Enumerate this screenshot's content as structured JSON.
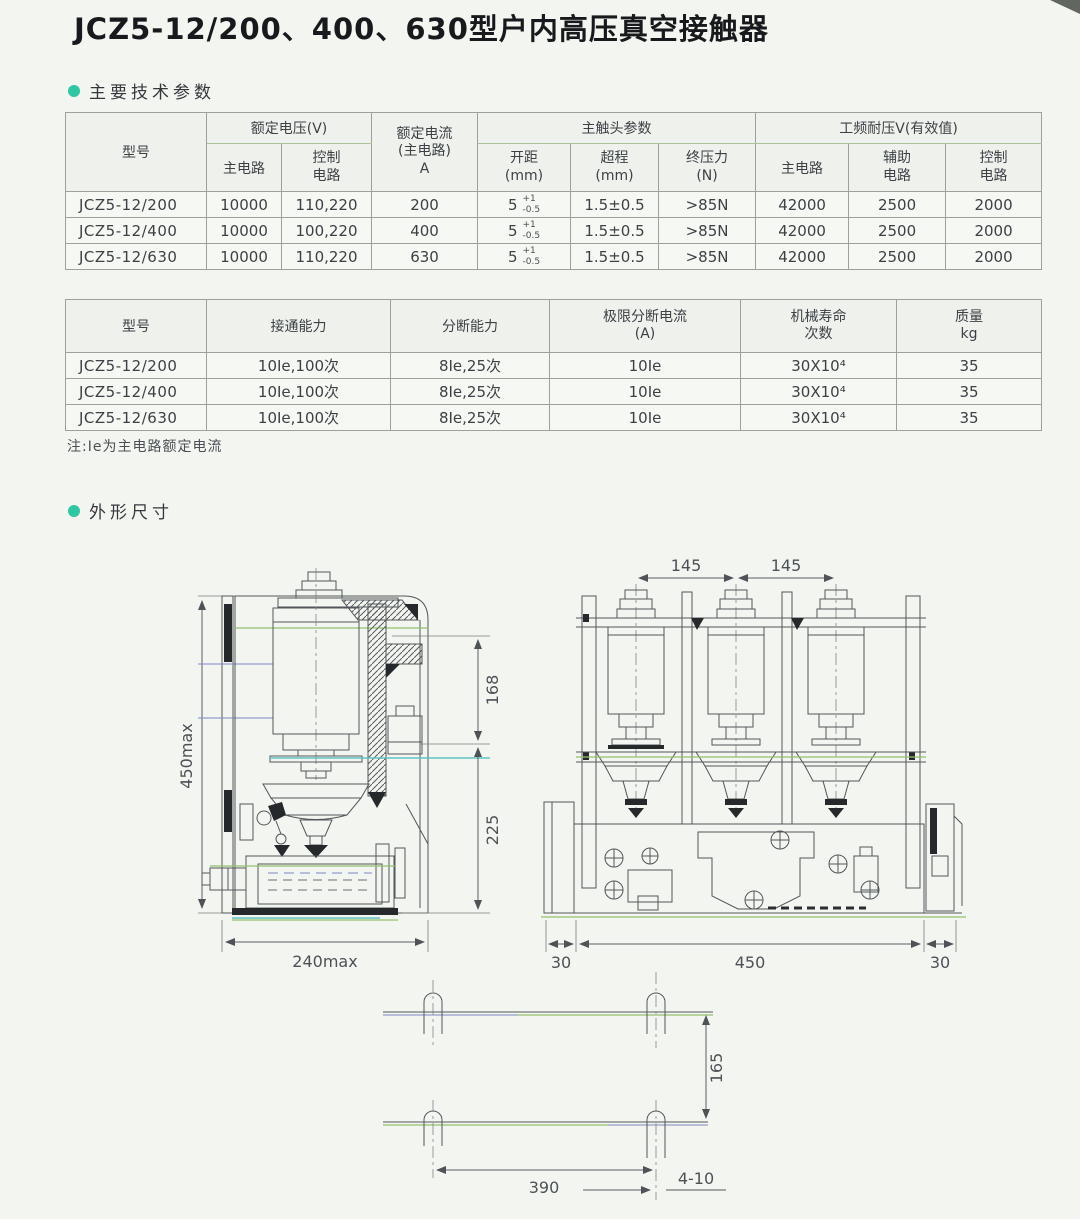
{
  "page": {
    "title": "JCZ5-12/200、400、630型户内高压真空接触器",
    "accent_color": "#2ec7a2"
  },
  "sections": {
    "params_label": "主要技术参数",
    "dims_label": "外形尺寸"
  },
  "table1": {
    "headers": {
      "model": "型号",
      "rated_voltage_group": "额定电压(V)",
      "main_circuit": "主电路",
      "control_circuit": "控制\n电路",
      "rated_current": "额定电流\n(主电路)\nA",
      "contact_group": "主触头参数",
      "opening": "开距\n(mm)",
      "overtravel": "超程\n(mm)",
      "final_pressure": "终压力\n(N)",
      "withstand_group": "工频耐压V(有效值)",
      "withstand_main": "主电路",
      "withstand_aux": "辅助\n电路",
      "withstand_control": "控制\n电路"
    },
    "rows": [
      {
        "model": "JCZ5-12/200",
        "main_v": "10000",
        "ctrl_v": "110,220",
        "current": "200",
        "open_base": "5",
        "open_sup": "+1",
        "open_sub": "-0.5",
        "overtravel": "1.5±0.5",
        "pressure": ">85N",
        "w_main": "42000",
        "w_aux": "2500",
        "w_ctrl": "2000"
      },
      {
        "model": "JCZ5-12/400",
        "main_v": "10000",
        "ctrl_v": "100,220",
        "current": "400",
        "open_base": "5",
        "open_sup": "+1",
        "open_sub": "-0.5",
        "overtravel": "1.5±0.5",
        "pressure": ">85N",
        "w_main": "42000",
        "w_aux": "2500",
        "w_ctrl": "2000"
      },
      {
        "model": "JCZ5-12/630",
        "main_v": "10000",
        "ctrl_v": "110,220",
        "current": "630",
        "open_base": "5",
        "open_sup": "+1",
        "open_sub": "-0.5",
        "overtravel": "1.5±0.5",
        "pressure": ">85N",
        "w_main": "42000",
        "w_aux": "2500",
        "w_ctrl": "2000"
      }
    ]
  },
  "table2": {
    "headers": {
      "model": "型号",
      "making": "接通能力",
      "breaking": "分断能力",
      "limit_current": "极限分断电流\n(A)",
      "mech_life": "机械寿命\n次数",
      "mass": "质量\nkg"
    },
    "rows": [
      {
        "model": "JCZ5-12/200",
        "making": "10Ie,100次",
        "breaking": "8Ie,25次",
        "limit": "10Ie",
        "life": "30X10⁴",
        "mass": "35"
      },
      {
        "model": "JCZ5-12/400",
        "making": "10Ie,100次",
        "breaking": "8Ie,25次",
        "limit": "10Ie",
        "life": "30X10⁴",
        "mass": "35"
      },
      {
        "model": "JCZ5-12/630",
        "making": "10Ie,100次",
        "breaking": "8Ie,25次",
        "limit": "10Ie",
        "life": "30X10⁴",
        "mass": "35"
      }
    ]
  },
  "note": "注:Ie为主电路额定电流",
  "drawings": {
    "side_view": {
      "overall_height": "450max",
      "overall_width": "240max",
      "upper_section": "168",
      "lower_section": "225"
    },
    "front_view": {
      "pole_pitch_left": "145",
      "pole_pitch_right": "145",
      "margin_left": "30",
      "mounting_width": "450",
      "margin_right": "30"
    },
    "plan_view": {
      "hole_pitch_y": "165",
      "hole_pitch_x": "390",
      "mounting_holes": "4-10"
    }
  }
}
